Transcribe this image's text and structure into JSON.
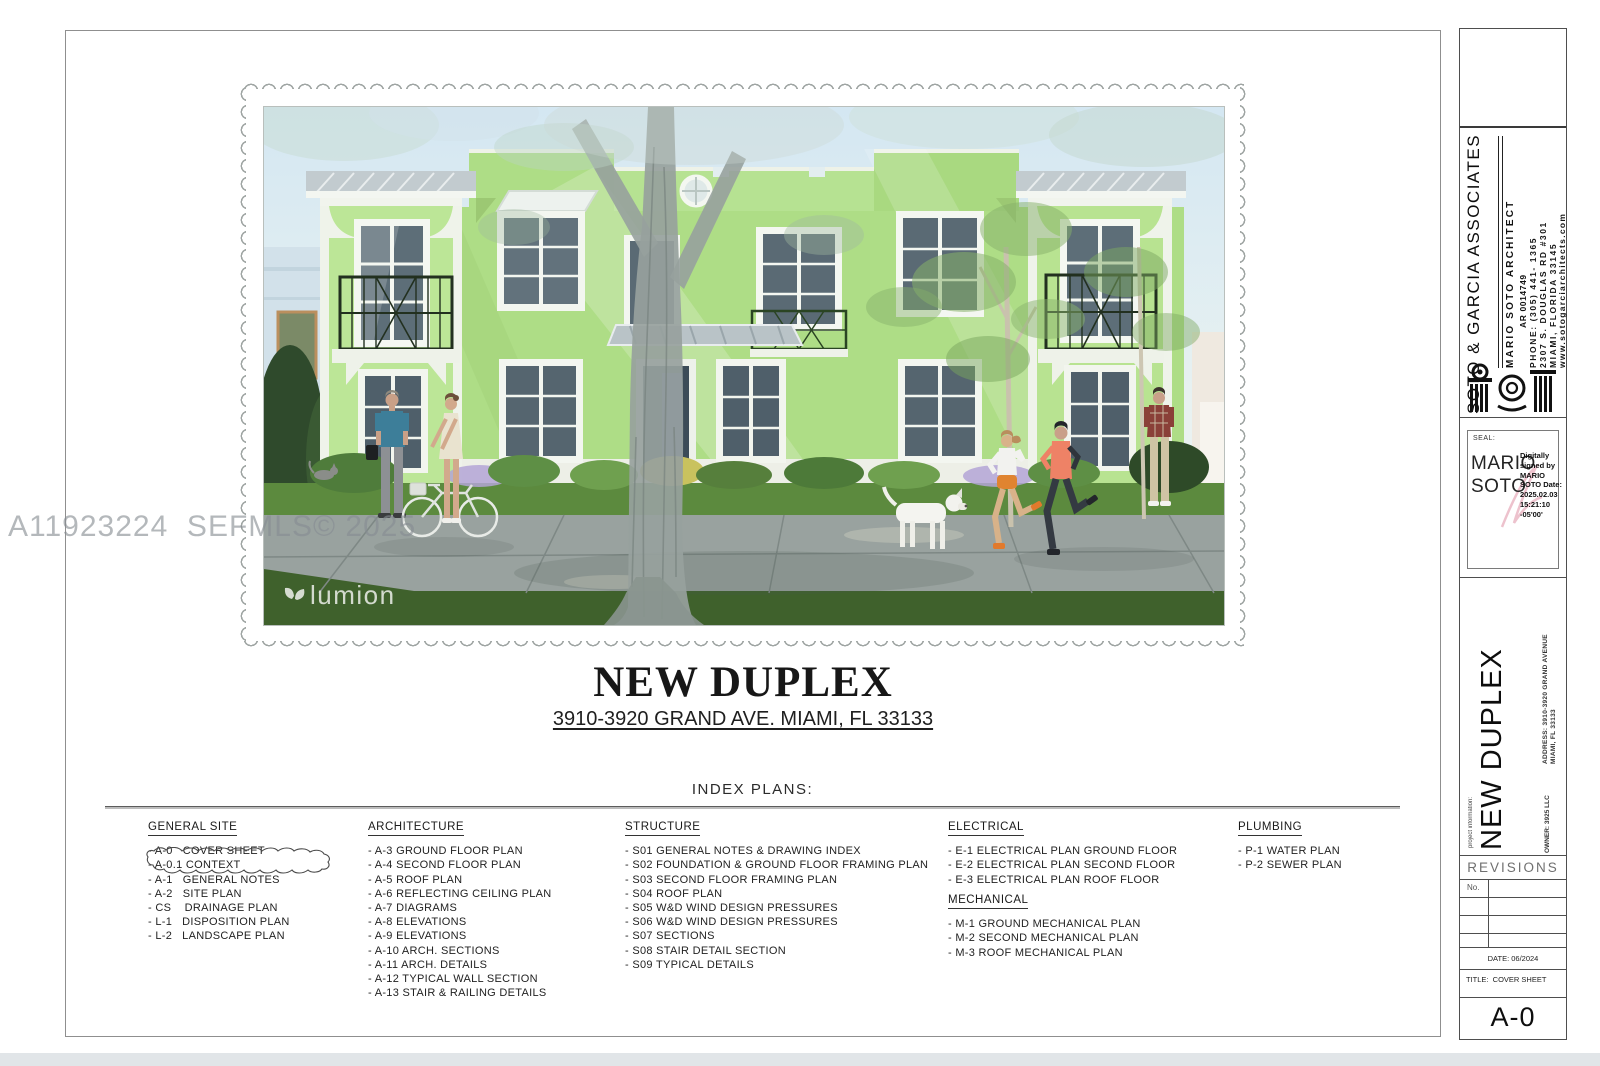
{
  "watermark": "A11923224  SEFMLS© 2025",
  "render": {
    "logo": "lumion"
  },
  "title_block": {
    "title": "NEW DUPLEX",
    "address": "3910-3920 GRAND AVE. MIAMI, FL 33133"
  },
  "index": {
    "heading": "INDEX PLANS:",
    "columns": [
      {
        "header": "GENERAL SITE",
        "items": [
          "- A-0   COVER SHEET",
          "- A-0.1 CONTEXT",
          "- A-1   GENERAL NOTES",
          "- A-2   SITE PLAN",
          "- CS    DRAINAGE PLAN",
          "- L-1   DISPOSITION PLAN",
          "- L-2   LANDSCAPE PLAN"
        ]
      },
      {
        "header": "ARCHITECTURE",
        "items": [
          "- A-3 GROUND FLOOR PLAN",
          "- A-4 SECOND FLOOR PLAN",
          "- A-5 ROOF PLAN",
          "- A-6 REFLECTING CEILING PLAN",
          "- A-7 DIAGRAMS",
          "- A-8 ELEVATIONS",
          "- A-9 ELEVATIONS",
          "- A-10 ARCH. SECTIONS",
          "- A-11 ARCH. DETAILS",
          "- A-12 TYPICAL WALL SECTION",
          "- A-13 STAIR & RAILING DETAILS"
        ]
      },
      {
        "header": "STRUCTURE",
        "items": [
          "- S01 GENERAL NOTES & DRAWING INDEX",
          "- S02 FOUNDATION & GROUND FLOOR FRAMING PLAN",
          "- S03 SECOND FLOOR FRAMING PLAN",
          "- S04 ROOF PLAN",
          "- S05 W&D WIND DESIGN PRESSURES",
          "- S06 W&D WIND DESIGN PRESSURES",
          "- S07 SECTIONS",
          "- S08 STAIR DETAIL SECTION",
          "- S09 TYPICAL DETAILS"
        ]
      },
      {
        "header": "ELECTRICAL",
        "items": [
          "- E-1 ELECTRICAL PLAN GROUND FLOOR",
          "- E-2 ELECTRICAL PLAN SECOND FLOOR",
          "- E-3 ELECTRICAL PLAN ROOF FLOOR"
        ]
      },
      {
        "header": "MECHANICAL",
        "items": [
          "- M-1 GROUND MECHANICAL PLAN",
          "- M-2 SECOND MECHANICAL PLAN",
          "- M-3 ROOF MECHANICAL PLAN"
        ]
      },
      {
        "header": "PLUMBING",
        "items": [
          "- P-1 WATER PLAN",
          "- P-2 SEWER PLAN"
        ]
      }
    ]
  },
  "sidebar": {
    "firm": "SOTO & GARCIA ASSOCIATES",
    "architect": "MARIO SOTO ARCHITECT",
    "license": "AR 0014749",
    "phone": "PHONE: (305) 441- 1365",
    "street": "2307 S. DOUGLAS RD #301",
    "city": "MIAMI, FLORIDA 33145",
    "website": "www.sotogarciarchitects.com",
    "seal_label": "SEAL:",
    "seal_name1": "MARIO",
    "seal_name2": "SOTO",
    "signature": "Digitally signed by MARIO SOTO Date: 2025.02.03 15:21:10 -05'00'",
    "project_address1": "ADDRESS: 3910-3920 GRAND AVENUE",
    "project_address2": "MIAMI, FL 33133",
    "project_info_label": "project information:",
    "project_name": "NEW DUPLEX",
    "owner": "OWNER: 3925 LLC",
    "revisions_label": "REVISIONS",
    "no_label": "No.",
    "date": "DATE: 06/2024",
    "sheet_title": "TITLE:  COVER SHEET",
    "sheet_number": "A-0",
    "colors": {
      "accent_green": "#aedd86",
      "trim_white": "#f2f5ee",
      "railing_dark": "#22301f"
    }
  }
}
